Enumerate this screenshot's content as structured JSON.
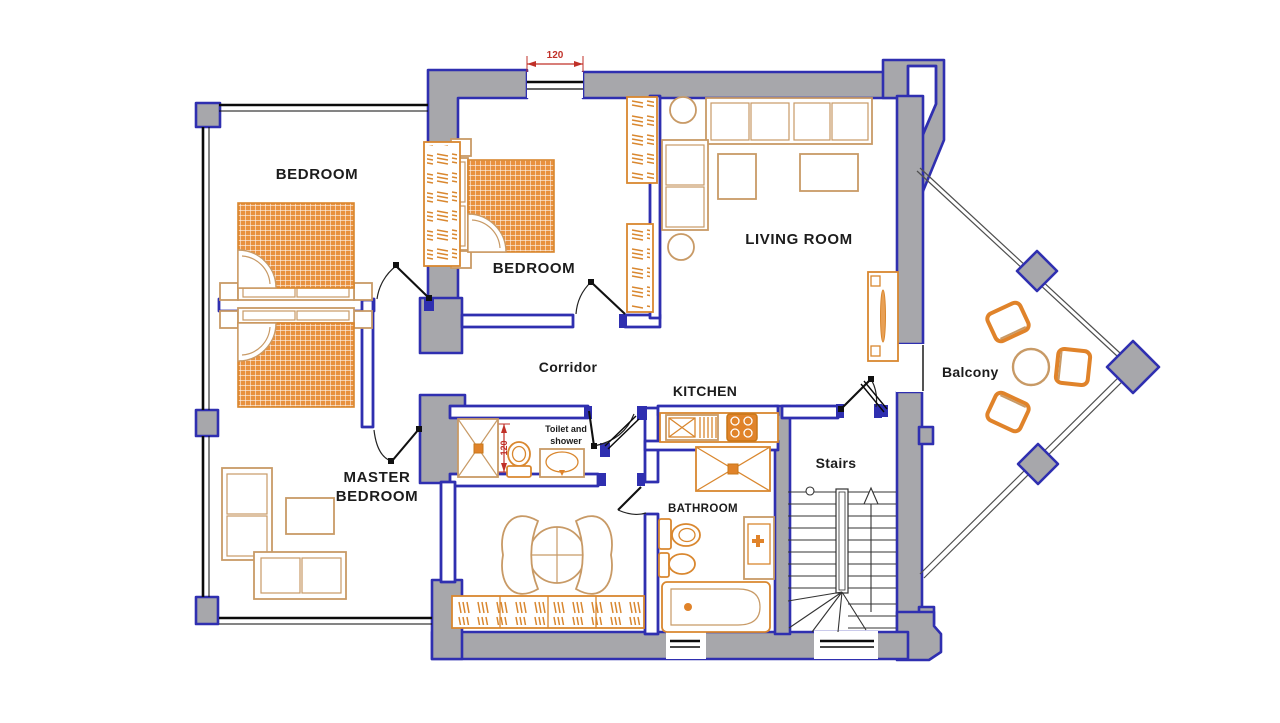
{
  "meta": {
    "type": "floor-plan",
    "description": "Apartment floor plan with balcony"
  },
  "colors": {
    "wall_fill": "#a7a7ab",
    "wall_stroke": "#2f2fb0",
    "furniture_orange": "#d9872f",
    "furniture_tan": "#c89a66",
    "stove_fill": "#e0832a",
    "dimension_red": "#c03028",
    "label_color": "#1c1c1c",
    "background": "#ffffff"
  },
  "rooms": {
    "bedroom_left": {
      "label": "BEDROOM"
    },
    "bedroom_middle": {
      "label": "BEDROOM"
    },
    "living_room": {
      "label": "LIVING ROOM"
    },
    "corridor": {
      "label": "Corridor"
    },
    "kitchen": {
      "label": "KITCHEN"
    },
    "master_bedroom": {
      "label_line1": "MASTER",
      "label_line2": "BEDROOM"
    },
    "toilet_shower": {
      "label_line1": "Toilet and",
      "label_line2": "shower"
    },
    "bathroom": {
      "label": "BATHROOM"
    },
    "stairs": {
      "label": "Stairs"
    },
    "balcony": {
      "label": "Balcony"
    }
  },
  "dims": {
    "window_top": "120",
    "toilet_room": "120"
  }
}
